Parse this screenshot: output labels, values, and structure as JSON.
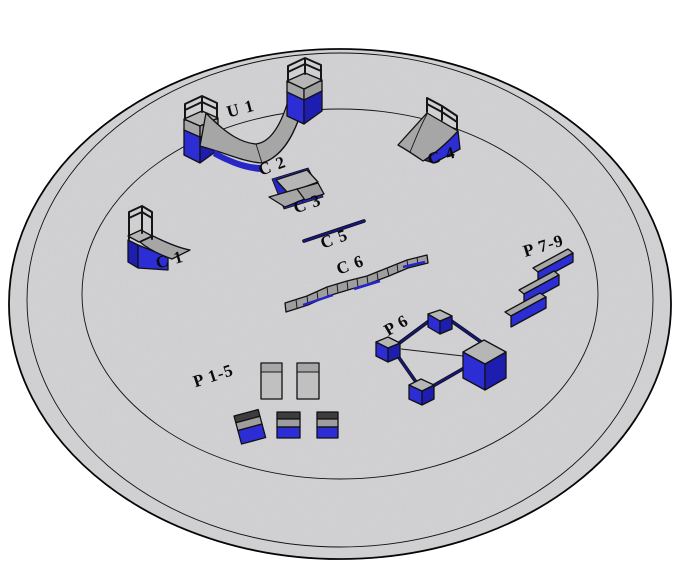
{
  "scene": {
    "description": "Isometric 3D render of skatepark equipment arranged on a circular pad"
  },
  "colors": {
    "background": "#ffffff",
    "platform": "#d3d3d5",
    "outline": "#111111",
    "label": "#0a0a0a",
    "blue_bright": "#2d2dd6",
    "blue_mid": "#2727c6",
    "blue_dark": "#1d1daf",
    "navy": "#16167e",
    "gray_surface": "#a6a6a6",
    "gray_deck": "#b6b6b6",
    "gray_light": "#c0c0c0",
    "gray_mid": "#9e9e9e",
    "gray_band": "#a7a7a7",
    "dark_band": "#3d3d3d"
  },
  "labels": {
    "u1": "U 1",
    "c1": "C 1",
    "c2": "C 2",
    "c3": "C 3",
    "c4": "C 4",
    "c5": "C 5",
    "c6": "C 6",
    "p6": "P 6",
    "p15": "P 1-5",
    "p79": "P 7-9"
  }
}
